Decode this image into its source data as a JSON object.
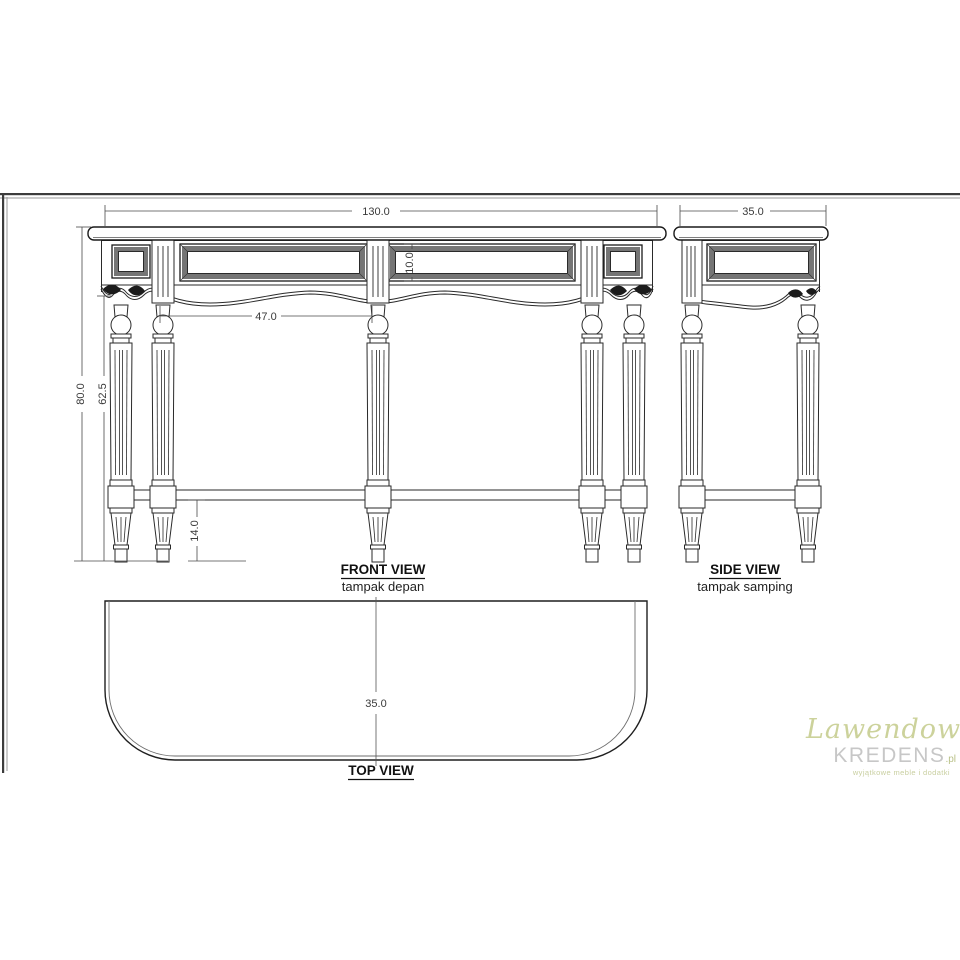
{
  "views": {
    "front": {
      "label": "FRONT VIEW",
      "sublabel": "tampak depan"
    },
    "side": {
      "label": "SIDE VIEW",
      "sublabel": "tampak samping"
    },
    "top": {
      "label": "TOP VIEW"
    }
  },
  "dimensions": {
    "front_width": "130.0",
    "side_depth": "35.0",
    "overall_height": "80.0",
    "leg_height": "62.5",
    "bay_width": "47.0",
    "panel_height": "10.0",
    "stretcher_clearance": "14.0",
    "top_depth": "35.0"
  },
  "watermark": {
    "script": "Lawendowy",
    "name": "KREDENS",
    "tld": ".pl",
    "tagline": "wyjątkowe meble i dodatki",
    "colors": {
      "script": "#ccd29b",
      "name": "#c7c7c7",
      "tagline": "#c9cfa0"
    }
  },
  "style": {
    "line_color": "#2a2a2a",
    "dim_color": "#3a3a3a",
    "panel_bevel_gray": "#757575",
    "background": "#ffffff"
  }
}
